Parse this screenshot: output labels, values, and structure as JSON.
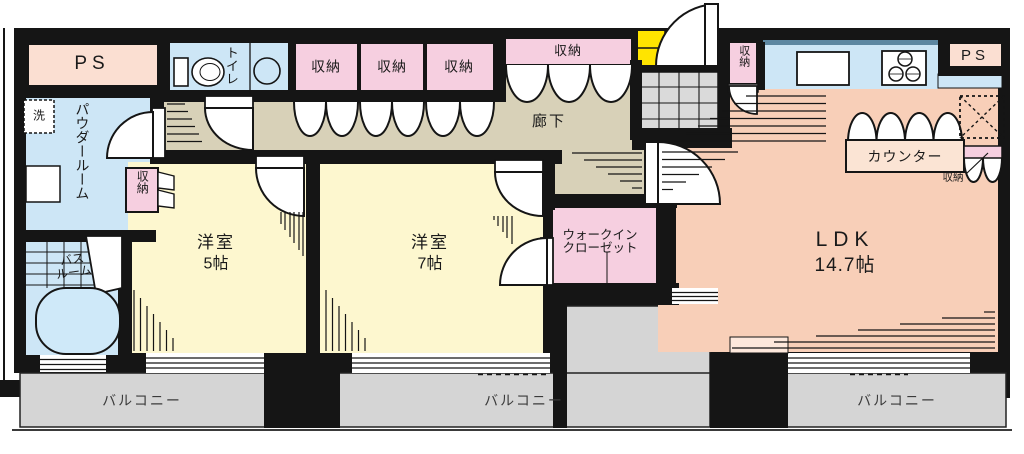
{
  "labels": {
    "ps_left": "PS",
    "ps_right": "PS",
    "toilet": "トイレ",
    "storage": "収納",
    "corridor": "廊下",
    "powder_room": "パウダールーム",
    "washer": "洗",
    "bath_line1": "バス",
    "bath_line2": "ルーム",
    "room5_name": "洋室",
    "room5_size": "5帖",
    "room7_name": "洋室",
    "room7_size": "7帖",
    "wic_line1": "ウォークイン",
    "wic_line2": "クローゼット",
    "ldk_name": "LDK",
    "ldk_size": "14.7帖",
    "counter": "カウンター",
    "balcony": "バルコニー"
  },
  "palette": {
    "wall": "#151515",
    "water_blue": "#cde6f6",
    "storage_pink": "#f6cfe0",
    "room_yellow": "#fdf7cf",
    "ldk_peach": "#f8cfb8",
    "corridor_tan": "#d8d1b8",
    "balcony_gray": "#d5d5d5",
    "tile_gray": "#dadada",
    "meter_box_yellow": "#ffe400",
    "ps_peach": "#fbdfd2",
    "counter_peach": "#fbe4d4",
    "kitchen_edge_blue": "#5d87a1",
    "tub_blue": "#cfe9f9"
  }
}
